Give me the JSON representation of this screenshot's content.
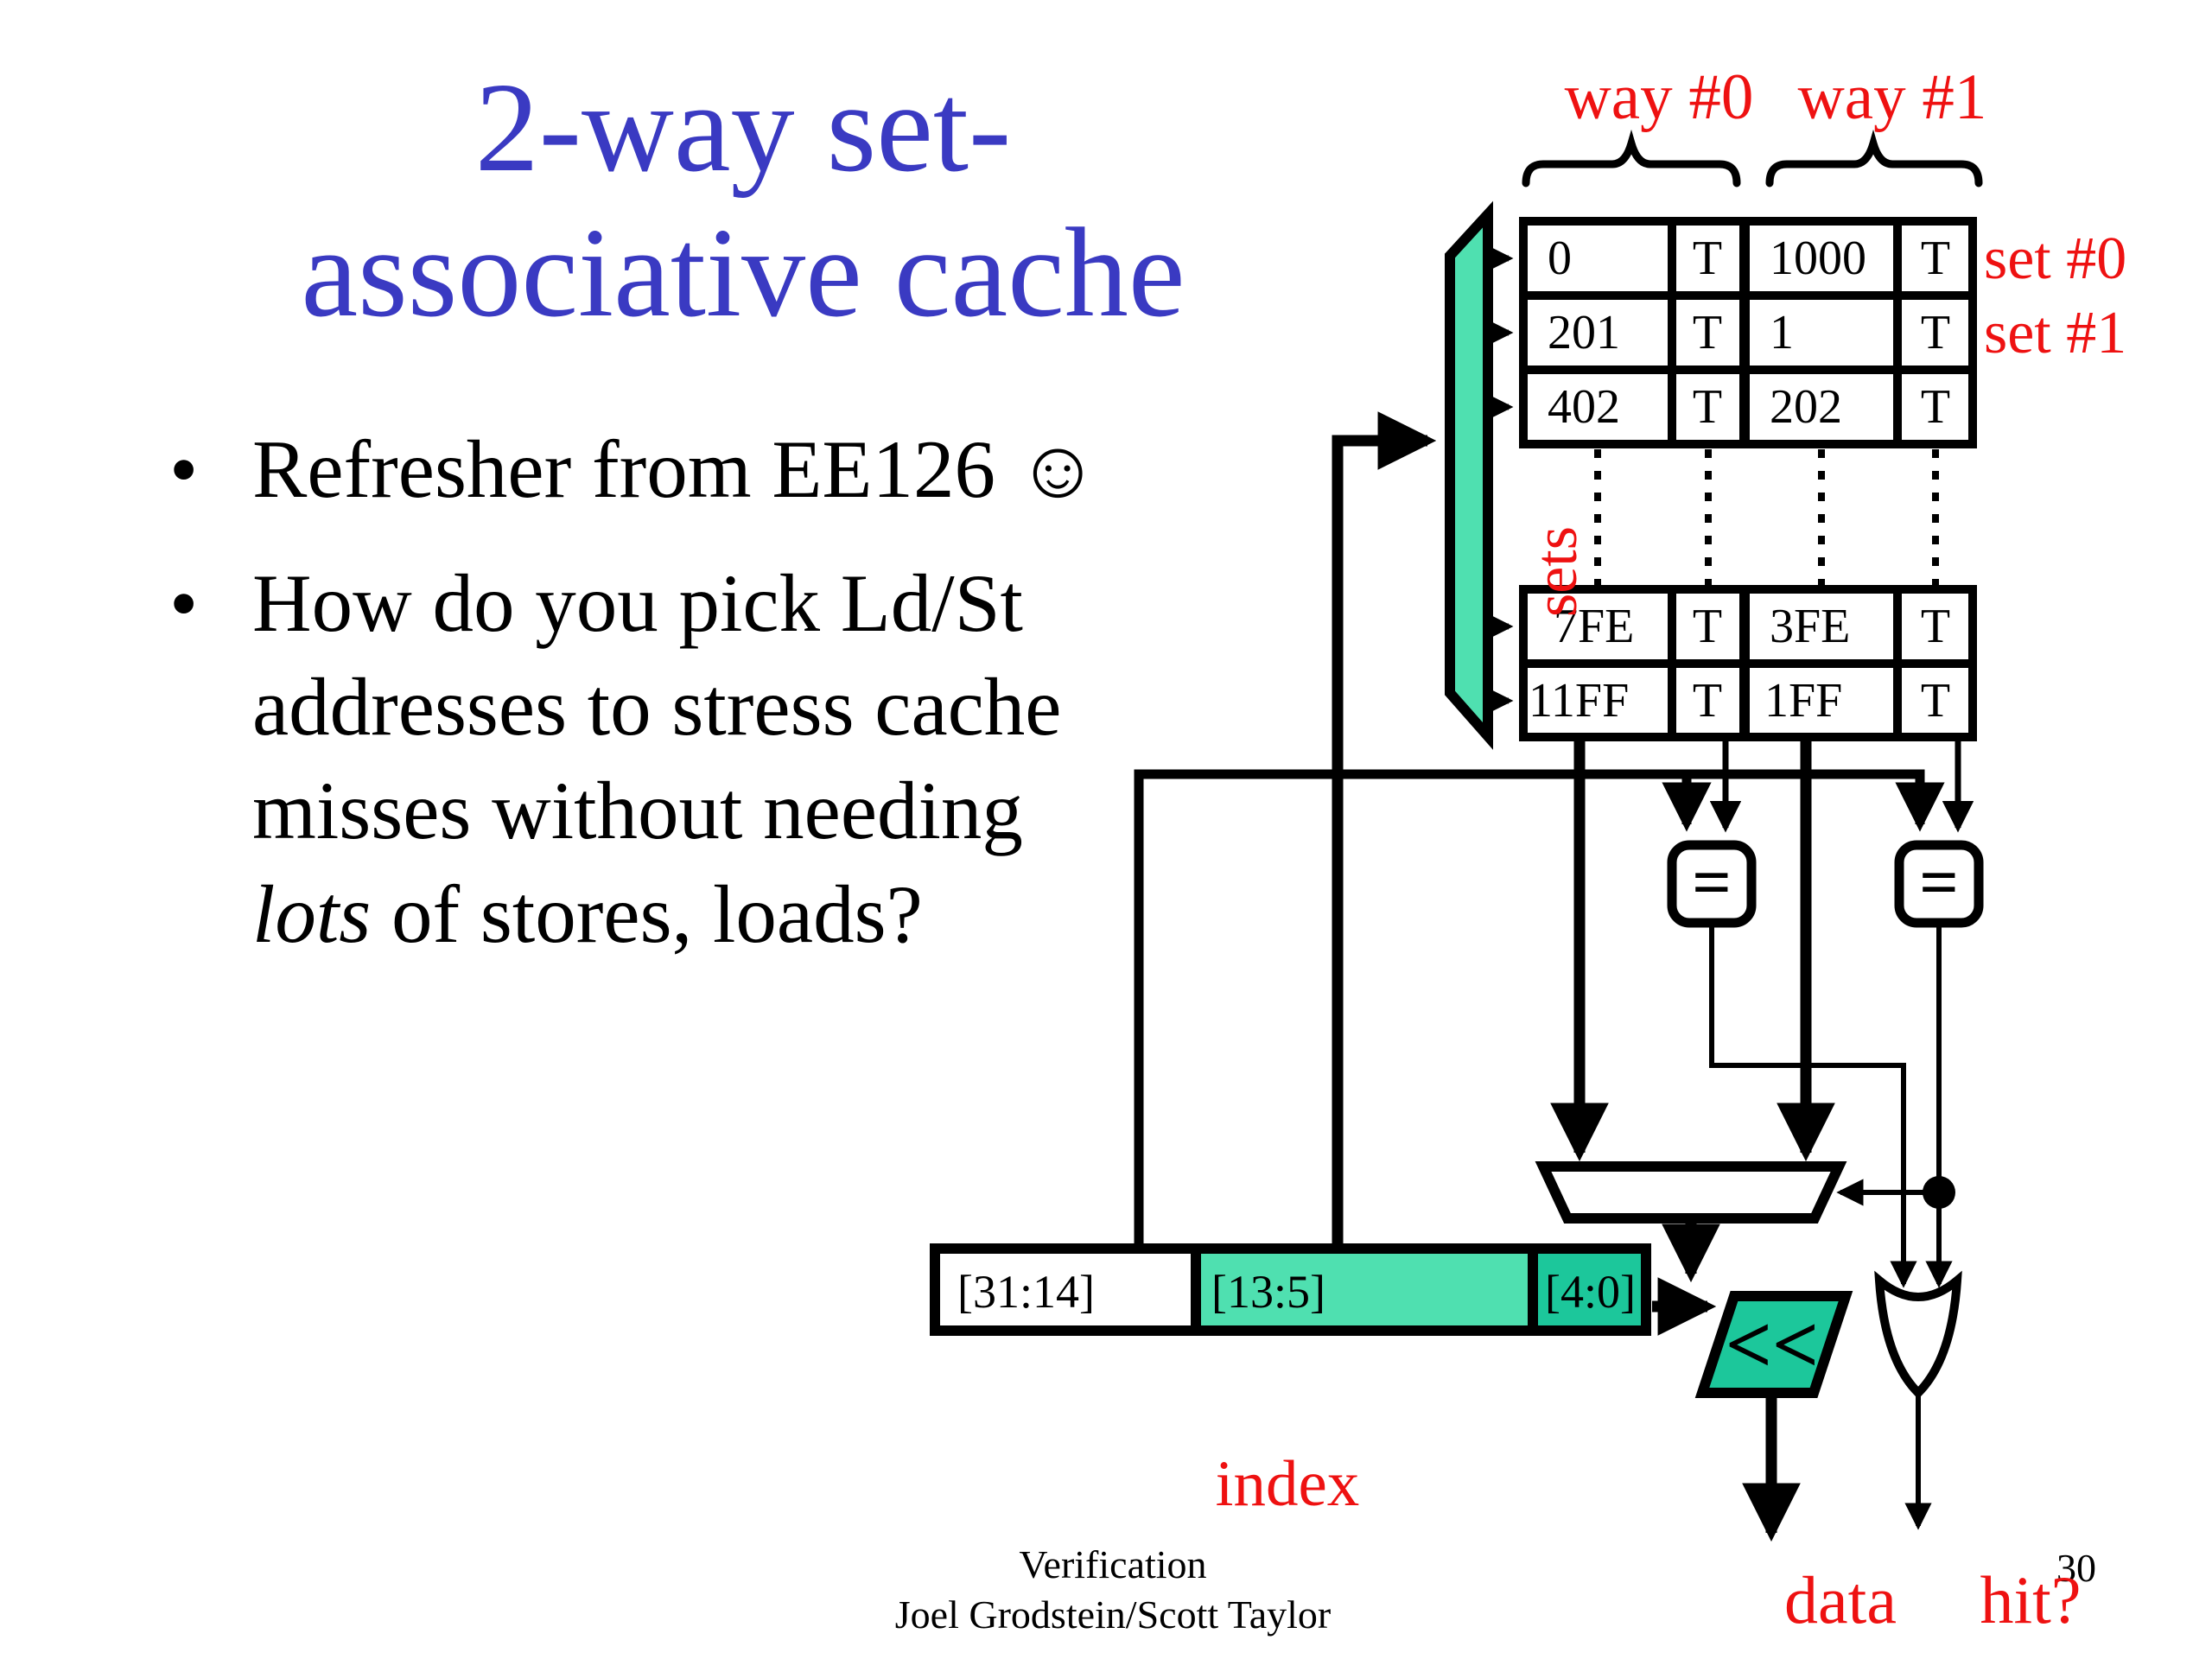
{
  "slide": {
    "title_line1": "2-way set-",
    "title_line2": "associative cache",
    "bullet_icon": "•",
    "bullets": {
      "item1": "Refresher from EE126 ☺",
      "item2_line1": "How do you pick Ld/St",
      "item2_line2": "addresses to stress cache",
      "item2_line3": "misses without needing",
      "item2_line4_italic": "lots",
      "item2_line4_rest": " of stores, loads?"
    },
    "footer": {
      "line1": "Verification",
      "line2": "Joel Grodstein/Scott Taylor",
      "page_number": "30"
    }
  },
  "diagram": {
    "way0_label": "way #0",
    "way1_label": "way #1",
    "set0_label": "set #0",
    "set1_label": "set #1",
    "sets_label": "sets",
    "index_label": "index",
    "data_label": "data",
    "hit_label": "hit?",
    "shifter_symbol": "<<",
    "comparator_symbol": "=",
    "address_fields": {
      "tag": "[31:14]",
      "index": "[13:5]",
      "offset": "[4:0]"
    },
    "table_top_rows": [
      [
        "0",
        "T",
        "1000",
        "T"
      ],
      [
        "201",
        "T",
        "1",
        "T"
      ],
      [
        "402",
        "T",
        "202",
        "T"
      ]
    ],
    "table_bottom_rows": [
      [
        "7FE",
        "T",
        "3FE",
        "T"
      ],
      [
        "11FF",
        "T",
        "1FF",
        "T"
      ]
    ]
  },
  "colors": {
    "title_blue": "#3A3AC2",
    "label_red": "#EE1111",
    "mint_green": "#4FE0B0",
    "teal_green": "#1CC79B"
  }
}
